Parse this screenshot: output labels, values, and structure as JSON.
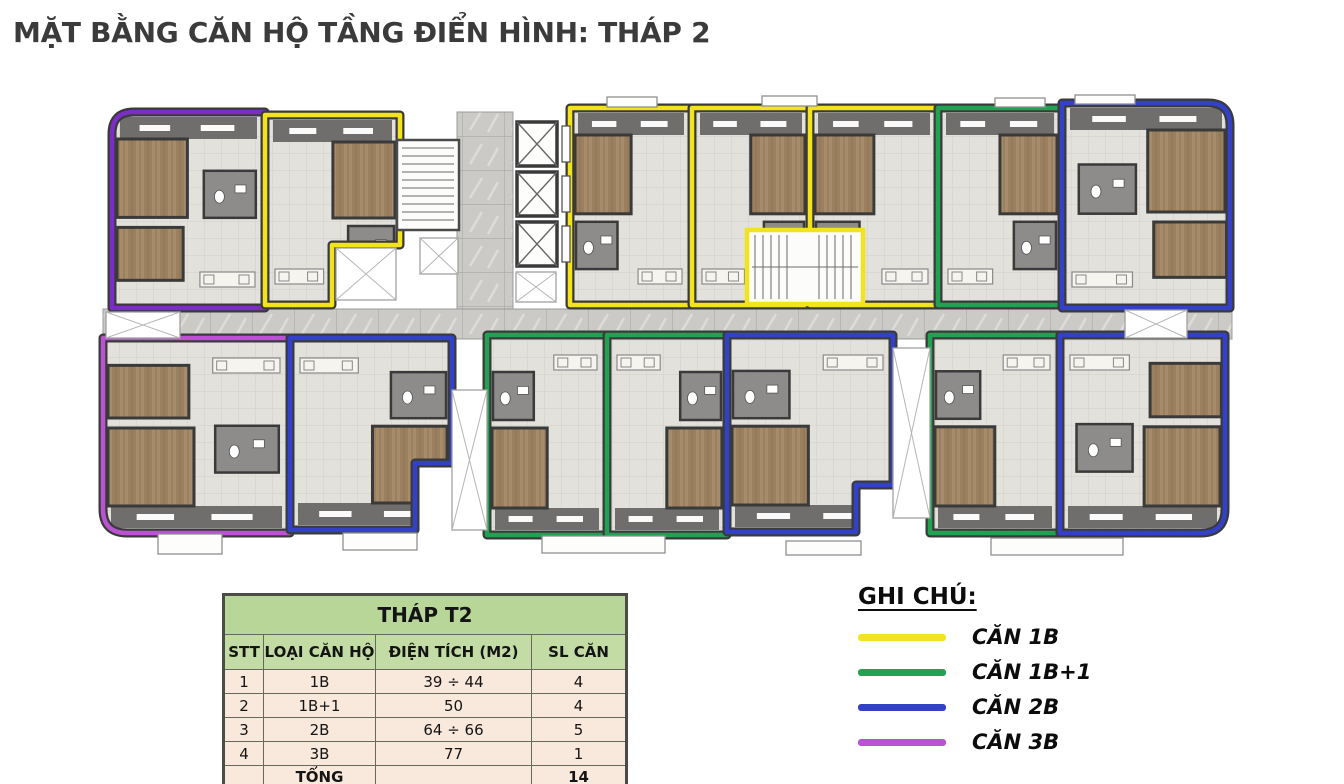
{
  "title": "MẶT BẰNG CĂN HỘ TẦNG ĐIỂN HÌNH: THÁP 2",
  "legend": {
    "heading": "GHI CHÚ:",
    "items": [
      {
        "label": "CĂN 1B",
        "color": "#f2e31c"
      },
      {
        "label": "CĂN 1B+1",
        "color": "#22a152"
      },
      {
        "label": "CĂN 2B",
        "color": "#3340c8"
      },
      {
        "label": "CĂN 3B",
        "color": "#bb52d4"
      }
    ]
  },
  "table": {
    "title": "THÁP T2",
    "headers": [
      "STT",
      "LOẠI CĂN HỘ",
      "ĐIỆN TÍCH (M2)",
      "SL CĂN"
    ],
    "rows": [
      [
        "1",
        "1B",
        "39 ÷ 44",
        "4"
      ],
      [
        "2",
        "1B+1",
        "50",
        "4"
      ],
      [
        "3",
        "2B",
        "64 ÷ 66",
        "5"
      ],
      [
        "4",
        "3B",
        "77",
        "1"
      ]
    ],
    "total_label": "TỔNG",
    "total_value": "14"
  },
  "floorplan": {
    "wall_color": "#3a3a3a",
    "corridor": [
      103,
      309,
      1129,
      30
    ],
    "lobby": [
      457,
      112,
      56,
      197
    ],
    "units": [
      {
        "type": "2B",
        "color": "#7b2ec6",
        "row": "top",
        "side": "left",
        "large": true,
        "path": "M134,112 H265 V308 H112 V134 Q112,112 134,112 Z",
        "bbox": [
          112,
          112,
          153,
          196
        ]
      },
      {
        "type": "1B",
        "color": "#f2e31c",
        "row": "top",
        "side": "right",
        "large": false,
        "path": "M265,115 H400 V245 H332 V305 H265 Z",
        "bbox": [
          265,
          115,
          135,
          190
        ]
      },
      {
        "type": "1B",
        "color": "#f2e31c",
        "row": "top",
        "side": "left",
        "large": false,
        "path": "M570,108 H692 V305 H570 Z",
        "bbox": [
          570,
          108,
          122,
          197
        ]
      },
      {
        "type": "1B",
        "color": "#f2e31c",
        "row": "top",
        "side": "right",
        "large": false,
        "path": "M692,108 H810 V305 H692 Z",
        "bbox": [
          692,
          108,
          118,
          197
        ]
      },
      {
        "type": "1B",
        "color": "#f2e31c",
        "row": "top",
        "side": "left",
        "large": false,
        "path": "M810,108 H938 V305 H810 Z",
        "bbox": [
          810,
          108,
          128,
          197
        ]
      },
      {
        "type": "1B+1",
        "color": "#22a152",
        "row": "top",
        "side": "right",
        "large": false,
        "path": "M938,108 H1062 V305 H938 Z",
        "bbox": [
          938,
          108,
          124,
          197
        ]
      },
      {
        "type": "2B",
        "color": "#3340c8",
        "row": "top",
        "side": "right",
        "large": true,
        "path": "M1062,103 H1208 Q1230,103 1230,125 V308 H1062 Z",
        "bbox": [
          1062,
          103,
          168,
          205
        ]
      },
      {
        "type": "3B",
        "color": "#bb52d4",
        "row": "bottom",
        "side": "left",
        "large": true,
        "path": "M103,338 H290 V533 H127 Q103,533 103,509 V338 Z",
        "bbox": [
          103,
          338,
          187,
          195
        ]
      },
      {
        "type": "2B",
        "color": "#3340c8",
        "row": "bottom",
        "side": "right",
        "large": false,
        "path": "M290,338 H452 V463 H415 V530 H290 Z",
        "bbox": [
          290,
          338,
          162,
          192
        ]
      },
      {
        "type": "1B+1",
        "color": "#22a152",
        "row": "bottom",
        "side": "left",
        "large": false,
        "path": "M487,335 H607 V535 H487 Z",
        "bbox": [
          487,
          335,
          120,
          200
        ]
      },
      {
        "type": "1B+1",
        "color": "#22a152",
        "row": "bottom",
        "side": "right",
        "large": false,
        "path": "M607,335 H727 V535 H607 Z",
        "bbox": [
          607,
          335,
          120,
          200
        ]
      },
      {
        "type": "2B",
        "color": "#3340c8",
        "row": "bottom",
        "side": "left",
        "large": false,
        "path": "M727,335 H893 V485 H856 V532 H727 Z",
        "bbox": [
          727,
          335,
          166,
          197
        ]
      },
      {
        "type": "1B+1",
        "color": "#22a152",
        "row": "bottom",
        "side": "left",
        "large": false,
        "path": "M930,335 H1060 V533 H930 Z",
        "bbox": [
          930,
          335,
          130,
          198
        ]
      },
      {
        "type": "2B",
        "color": "#3340c8",
        "row": "bottom",
        "side": "right",
        "large": true,
        "path": "M1060,335 H1225 V509 Q1225,533 1201,533 H1060 Z",
        "bbox": [
          1060,
          335,
          165,
          198
        ]
      }
    ],
    "stairs": [
      {
        "rect": [
          397,
          140,
          62,
          90
        ]
      },
      {
        "rect": [
          747,
          230,
          116,
          74
        ],
        "outline": "#f2e31c"
      }
    ],
    "elevators": [
      [
        517,
        122,
        40,
        44
      ],
      [
        517,
        172,
        40,
        44
      ],
      [
        517,
        222,
        40,
        44
      ]
    ],
    "voids": [
      [
        336,
        248,
        60,
        52
      ],
      [
        420,
        238,
        38,
        36
      ],
      [
        516,
        272,
        40,
        30
      ],
      [
        452,
        390,
        35,
        140
      ],
      [
        893,
        348,
        37,
        170
      ],
      [
        1125,
        310,
        62,
        28
      ],
      [
        106,
        312,
        74,
        26
      ]
    ],
    "balconies": [
      [
        158,
        534,
        64,
        20
      ],
      [
        343,
        533,
        74,
        17
      ],
      [
        542,
        536,
        123,
        17
      ],
      [
        786,
        541,
        75,
        14
      ],
      [
        991,
        538,
        132,
        17
      ],
      [
        607,
        97,
        50,
        10
      ],
      [
        762,
        96,
        55,
        10
      ],
      [
        995,
        98,
        50,
        9
      ],
      [
        1075,
        95,
        60,
        9
      ]
    ]
  }
}
